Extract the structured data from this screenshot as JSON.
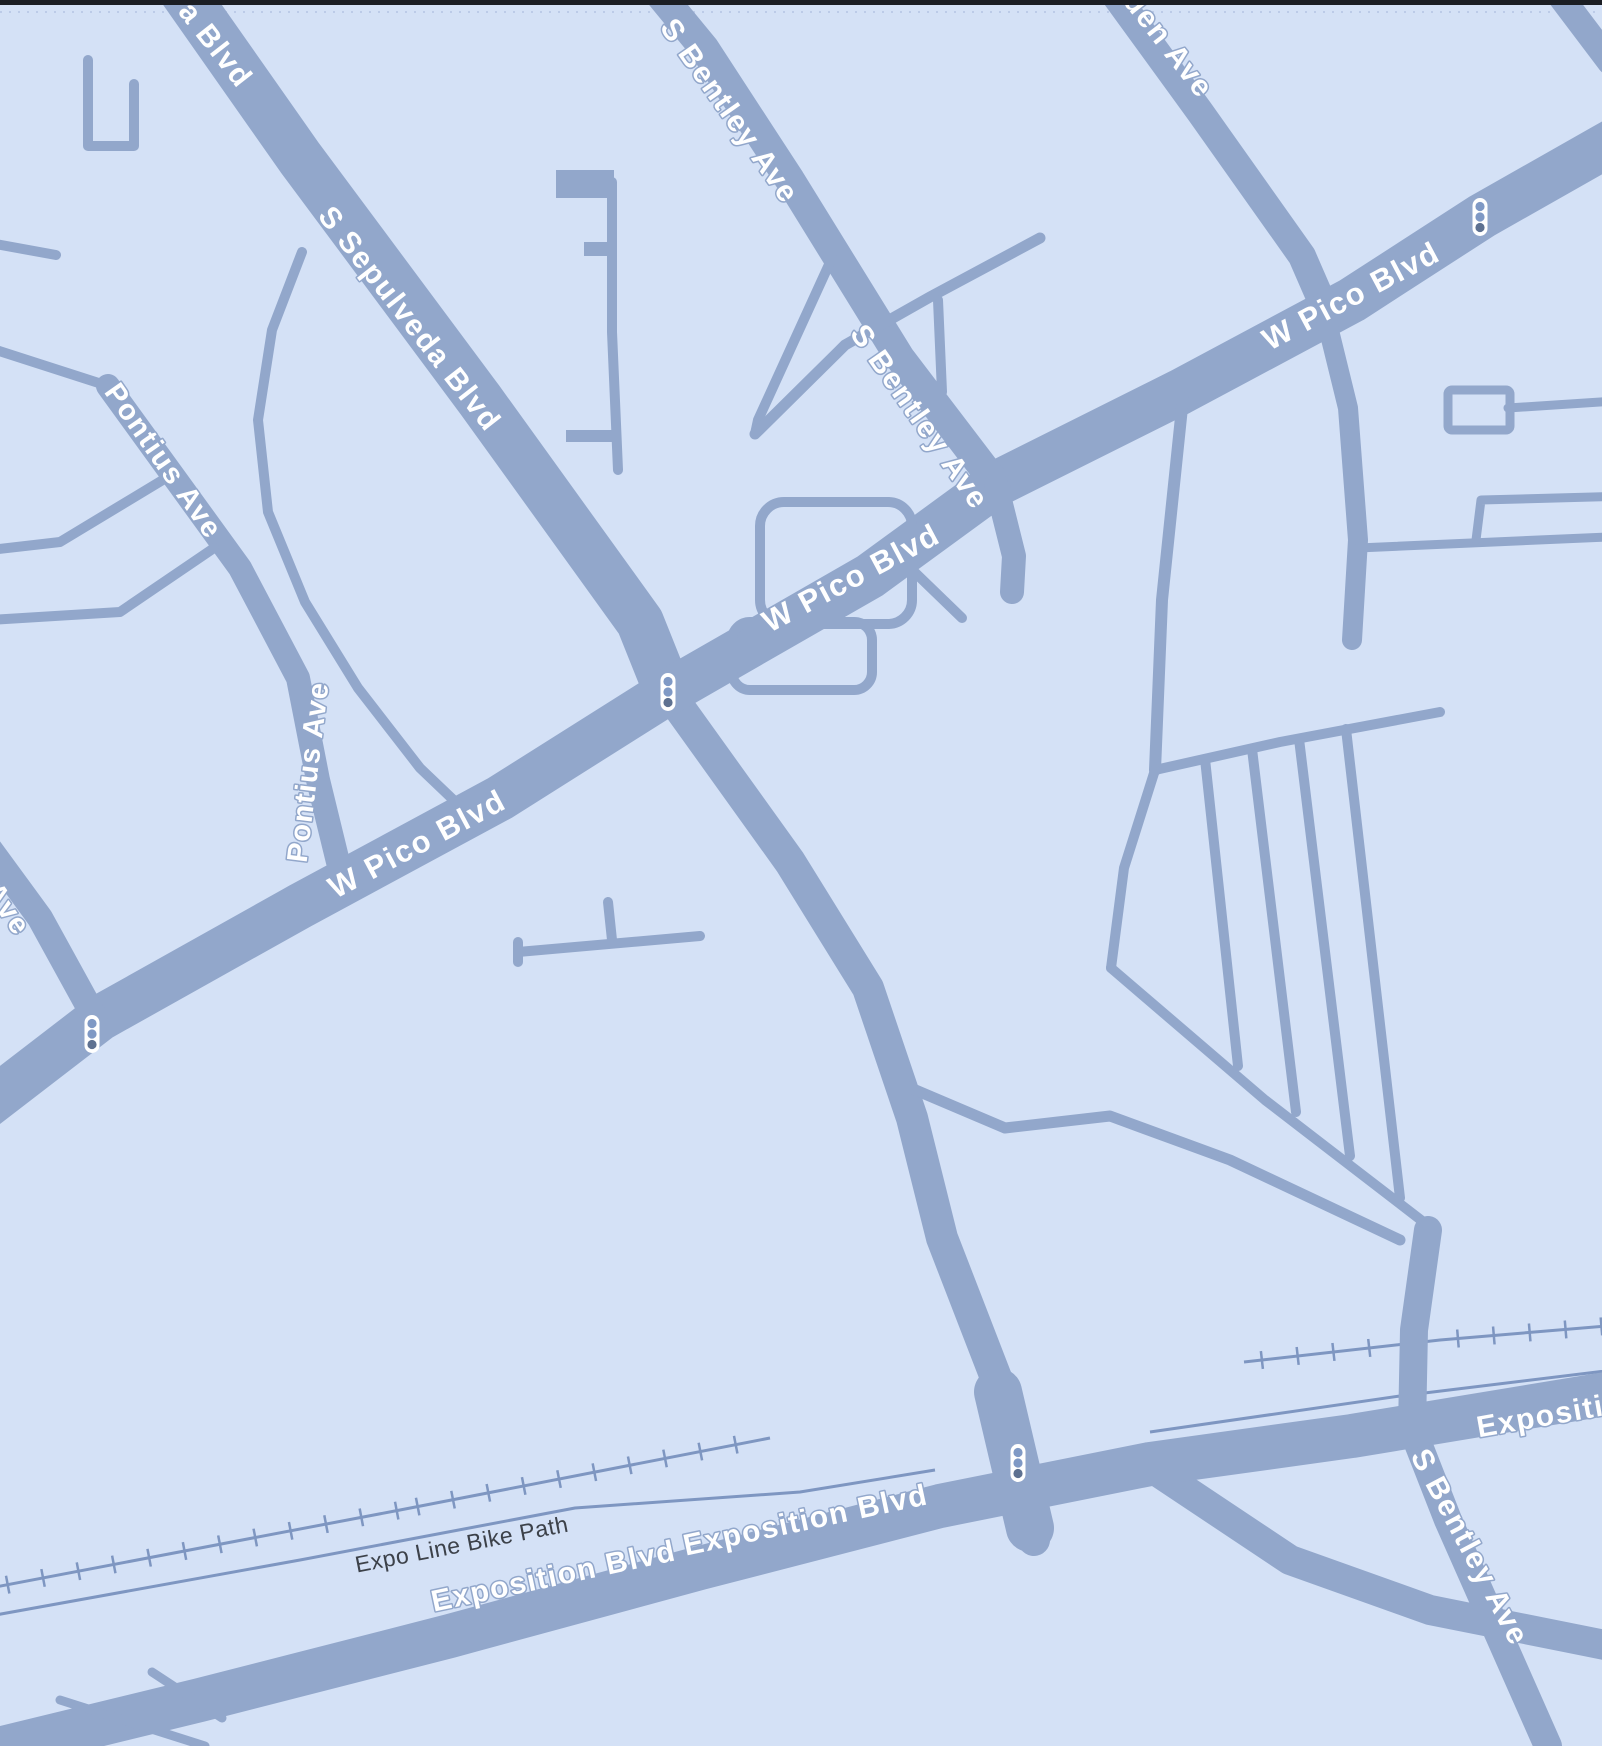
{
  "map": {
    "width": 1602,
    "height": 1746,
    "colors": {
      "background": "#d4e1f6",
      "road": "#92a7cb",
      "rail": "#7e96c1",
      "label_white": "#ffffff",
      "label_dark": "#3c4149",
      "top_bar": "#1b1e24",
      "boundary_dots": "#bccbe8",
      "signal_body": "#ffffff",
      "signal_lens": "#7f99c5",
      "signal_lens_dark": "#5e7191"
    },
    "top_bar_height": 5,
    "boundary_line_y": 12,
    "roads": [
      {
        "name": "road-s-sepulveda-blvd-north",
        "width": 48,
        "points": [
          [
            175,
            -20
          ],
          [
            300,
            158
          ],
          [
            480,
            400
          ],
          [
            640,
            622
          ],
          [
            668,
            692
          ]
        ]
      },
      {
        "name": "road-s-sepulveda-blvd-south",
        "width": 32,
        "points": [
          [
            668,
            692
          ],
          [
            790,
            862
          ],
          [
            868,
            988
          ],
          [
            912,
            1118
          ],
          [
            942,
            1238
          ],
          [
            1000,
            1388
          ],
          [
            1018,
            1462
          ],
          [
            1034,
            1540
          ]
        ]
      },
      {
        "name": "road-sepulveda-exposition-junction",
        "width": 48,
        "points": [
          [
            998,
            1392
          ],
          [
            1030,
            1528
          ]
        ]
      },
      {
        "name": "road-w-pico-blvd",
        "width": 46,
        "points": [
          [
            -30,
            1118
          ],
          [
            100,
            1018
          ],
          [
            300,
            906
          ],
          [
            500,
            798
          ],
          [
            668,
            692
          ],
          [
            870,
            576
          ],
          [
            996,
            484
          ],
          [
            1180,
            392
          ],
          [
            1352,
            300
          ],
          [
            1482,
            216
          ],
          [
            1630,
            132
          ]
        ]
      },
      {
        "name": "road-s-bentley-ave-north",
        "width": 30,
        "points": [
          [
            648,
            -20
          ],
          [
            704,
            48
          ],
          [
            790,
            180
          ],
          [
            900,
            358
          ],
          [
            996,
            484
          ]
        ]
      },
      {
        "name": "road-s-bentley-ave-stub",
        "width": 24,
        "points": [
          [
            996,
            484
          ],
          [
            1014,
            556
          ],
          [
            1012,
            592
          ]
        ]
      },
      {
        "name": "road-den-ave",
        "width": 28,
        "points": [
          [
            1104,
            -20
          ],
          [
            1200,
            112
          ],
          [
            1302,
            256
          ],
          [
            1322,
            302
          ]
        ]
      },
      {
        "name": "road-den-ave-south",
        "width": 20,
        "points": [
          [
            1322,
            302
          ],
          [
            1348,
            408
          ],
          [
            1358,
            540
          ],
          [
            1352,
            640
          ]
        ]
      },
      {
        "name": "road-ave-west",
        "width": 26,
        "points": [
          [
            -20,
            836
          ],
          [
            40,
            918
          ],
          [
            95,
            1018
          ]
        ]
      },
      {
        "name": "road-s-bentley-ave-south",
        "width": 28,
        "points": [
          [
            1428,
            1230
          ],
          [
            1414,
            1330
          ],
          [
            1412,
            1428
          ],
          [
            1448,
            1520
          ],
          [
            1502,
            1642
          ],
          [
            1548,
            1746
          ]
        ]
      },
      {
        "name": "road-south-band",
        "width": 30,
        "points": [
          [
            1152,
            1468
          ],
          [
            1290,
            1560
          ],
          [
            1430,
            1610
          ],
          [
            1630,
            1650
          ]
        ]
      },
      {
        "name": "road-exposition-blvd",
        "width": 44,
        "points": [
          [
            -30,
            1756
          ],
          [
            200,
            1700
          ],
          [
            450,
            1636
          ],
          [
            700,
            1568
          ],
          [
            940,
            1506
          ],
          [
            1150,
            1464
          ],
          [
            1352,
            1436
          ],
          [
            1630,
            1390
          ]
        ]
      },
      {
        "name": "road-corner-ne",
        "width": 26,
        "points": [
          [
            1548,
            -20
          ],
          [
            1610,
            62
          ]
        ]
      },
      {
        "name": "road-pontius-ave",
        "width": 24,
        "points": [
          [
            108,
            386
          ],
          [
            240,
            568
          ],
          [
            298,
            678
          ],
          [
            318,
            780
          ],
          [
            338,
            862
          ],
          [
            352,
            884
          ]
        ]
      },
      {
        "name": "road-hook-top-left",
        "width": 10,
        "points": [
          [
            88,
            60
          ],
          [
            88,
            146
          ],
          [
            134,
            146
          ],
          [
            134,
            84
          ]
        ]
      },
      {
        "name": "road-left-stub-1",
        "width": 10,
        "points": [
          [
            -10,
            243
          ],
          [
            56,
            255
          ]
        ]
      },
      {
        "name": "road-pontius-link",
        "width": 10,
        "points": [
          [
            -10,
            348
          ],
          [
            108,
            386
          ]
        ]
      },
      {
        "name": "road-pontius-side-1",
        "width": 10,
        "points": [
          [
            166,
            478
          ],
          [
            60,
            542
          ],
          [
            -10,
            550
          ]
        ]
      },
      {
        "name": "road-pontius-side-2",
        "width": 10,
        "points": [
          [
            214,
            548
          ],
          [
            120,
            612
          ],
          [
            -10,
            620
          ]
        ]
      },
      {
        "name": "road-sepulveda-loop",
        "width": 10,
        "points": [
          [
            302,
            252
          ],
          [
            272,
            330
          ],
          [
            258,
            420
          ],
          [
            268,
            512
          ],
          [
            305,
            602
          ],
          [
            358,
            688
          ],
          [
            420,
            768
          ],
          [
            464,
            810
          ]
        ]
      },
      {
        "name": "road-alley-vertical",
        "width": 10,
        "points": [
          [
            612,
            182
          ],
          [
            612,
            332
          ],
          [
            618,
            470
          ]
        ]
      },
      {
        "name": "road-alley-branch",
        "width": 10,
        "points": [
          [
            832,
            258
          ],
          [
            758,
            420
          ],
          [
            755,
            434
          ]
        ]
      },
      {
        "name": "road-cross-street",
        "width": 11,
        "points": [
          [
            755,
            434
          ],
          [
            838,
            352
          ],
          [
            845,
            345
          ],
          [
            930,
            297
          ],
          [
            1040,
            238
          ]
        ]
      },
      {
        "name": "road-cross-stub",
        "width": 10,
        "points": [
          [
            938,
            300
          ],
          [
            942,
            392
          ]
        ]
      },
      {
        "name": "road-short-diagonal",
        "width": 10,
        "points": [
          [
            902,
            560
          ],
          [
            962,
            618
          ]
        ]
      },
      {
        "name": "road-t-stub",
        "width": 10,
        "points": [
          [
            518,
            952
          ],
          [
            700,
            936
          ]
        ]
      },
      {
        "name": "road-t-stub-up",
        "width": 10,
        "points": [
          [
            612,
            940
          ],
          [
            608,
            902
          ]
        ]
      },
      {
        "name": "road-t-stub-tick",
        "width": 10,
        "points": [
          [
            518,
            962
          ],
          [
            518,
            942
          ]
        ]
      },
      {
        "name": "road-military-link",
        "width": 12,
        "points": [
          [
            1183,
            398
          ],
          [
            1162,
            600
          ],
          [
            1155,
            770
          ]
        ]
      },
      {
        "name": "road-fan-top",
        "width": 10,
        "points": [
          [
            1155,
            770
          ],
          [
            1280,
            742
          ],
          [
            1440,
            712
          ]
        ]
      },
      {
        "name": "road-fan-left",
        "width": 10,
        "points": [
          [
            1155,
            770
          ],
          [
            1124,
            868
          ],
          [
            1111,
            968
          ]
        ]
      },
      {
        "name": "road-fan-bottom",
        "width": 10,
        "points": [
          [
            1111,
            968
          ],
          [
            1265,
            1100
          ],
          [
            1430,
            1227
          ]
        ]
      },
      {
        "name": "road-fan-1",
        "width": 10,
        "points": [
          [
            1205,
            759
          ],
          [
            1238,
            1066
          ]
        ]
      },
      {
        "name": "road-fan-2",
        "width": 10,
        "points": [
          [
            1252,
            749
          ],
          [
            1296,
            1112
          ]
        ]
      },
      {
        "name": "road-fan-3",
        "width": 10,
        "points": [
          [
            1299,
            739
          ],
          [
            1350,
            1156
          ]
        ]
      },
      {
        "name": "road-fan-4",
        "width": 10,
        "points": [
          [
            1346,
            729
          ],
          [
            1400,
            1198
          ]
        ]
      },
      {
        "name": "road-below-fan",
        "width": 11,
        "points": [
          [
            906,
            1086
          ],
          [
            1005,
            1128
          ],
          [
            1110,
            1116
          ],
          [
            1230,
            1160
          ],
          [
            1400,
            1240
          ]
        ]
      },
      {
        "name": "road-bottom-left-1",
        "width": 9,
        "points": [
          [
            60,
            1700
          ],
          [
            205,
            1746
          ]
        ]
      },
      {
        "name": "road-bottom-left-2",
        "width": 9,
        "points": [
          [
            152,
            1672
          ],
          [
            222,
            1718
          ]
        ]
      },
      {
        "name": "road-right-stub",
        "width": 9,
        "points": [
          [
            1508,
            408
          ],
          [
            1630,
            400
          ]
        ]
      },
      {
        "name": "road-right-a",
        "width": 9,
        "points": [
          [
            1358,
            548
          ],
          [
            1630,
            536
          ]
        ]
      },
      {
        "name": "road-right-b",
        "width": 9,
        "points": [
          [
            1476,
            540
          ],
          [
            1481,
            500
          ],
          [
            1630,
            496
          ]
        ]
      }
    ],
    "road_rects": [
      {
        "name": "block-notch-1",
        "x": 556,
        "y": 170,
        "w": 58,
        "h": 28
      },
      {
        "name": "block-notch-2",
        "x": 584,
        "y": 242,
        "w": 28,
        "h": 14
      },
      {
        "name": "block-notch-3",
        "x": 566,
        "y": 430,
        "w": 52,
        "h": 12
      }
    ],
    "road_outline_rects": [
      {
        "name": "loop-block-upper",
        "x": 760,
        "y": 502,
        "w": 152,
        "h": 122,
        "r": 24,
        "width": 10
      },
      {
        "name": "loop-block-lower",
        "x": 732,
        "y": 622,
        "w": 140,
        "h": 68,
        "r": 18,
        "width": 10
      },
      {
        "name": "right-edge-block",
        "x": 1448,
        "y": 390,
        "w": 62,
        "h": 40,
        "r": 4,
        "width": 9
      }
    ],
    "rails": [
      {
        "name": "expo-line-west",
        "ticks": true,
        "points": [
          [
            -10,
            1588
          ],
          [
            400,
            1510
          ],
          [
            770,
            1438
          ]
        ]
      },
      {
        "name": "expo-line-east",
        "ticks": true,
        "points": [
          [
            1244,
            1362
          ],
          [
            1440,
            1340
          ],
          [
            1630,
            1324
          ]
        ]
      },
      {
        "name": "bike-path-west",
        "ticks": false,
        "points": [
          [
            -10,
            1616
          ],
          [
            300,
            1560
          ],
          [
            575,
            1508
          ],
          [
            800,
            1492
          ],
          [
            935,
            1470
          ]
        ]
      },
      {
        "name": "bike-path-east",
        "ticks": false,
        "points": [
          [
            1150,
            1432
          ],
          [
            1400,
            1396
          ],
          [
            1630,
            1368
          ]
        ]
      }
    ],
    "labels": [
      {
        "text": "a Blvd",
        "x": 214,
        "y": 46,
        "rotation": 52,
        "size": 30,
        "kind": "road"
      },
      {
        "text": "S Sepulveda Blvd",
        "x": 408,
        "y": 320,
        "rotation": 52,
        "size": 30,
        "kind": "road"
      },
      {
        "text": "S Bentley Ave",
        "x": 728,
        "y": 112,
        "rotation": 55,
        "size": 30,
        "kind": "road"
      },
      {
        "text": "S Bentley Ave",
        "x": 918,
        "y": 418,
        "rotation": 55,
        "size": 30,
        "kind": "road"
      },
      {
        "text": "den Ave",
        "x": 1167,
        "y": 46,
        "rotation": 52,
        "size": 30,
        "kind": "road"
      },
      {
        "text": "W Pico Blvd",
        "x": 1352,
        "y": 298,
        "rotation": -28,
        "size": 31,
        "kind": "road"
      },
      {
        "text": "W Pico Blvd",
        "x": 852,
        "y": 580,
        "rotation": -28,
        "size": 31,
        "kind": "road"
      },
      {
        "text": "W Pico Blvd",
        "x": 418,
        "y": 846,
        "rotation": -28,
        "size": 31,
        "kind": "road"
      },
      {
        "text": "Pontius Ave",
        "x": 162,
        "y": 462,
        "rotation": 55,
        "size": 29,
        "kind": "road"
      },
      {
        "text": "Pontius Ave",
        "x": 310,
        "y": 772,
        "rotation": -83,
        "size": 29,
        "kind": "road"
      },
      {
        "text": "Ave",
        "x": 6,
        "y": 910,
        "rotation": 55,
        "size": 29,
        "kind": "road"
      },
      {
        "text": "Expo Line Bike Path",
        "x": 462,
        "y": 1546,
        "rotation": -11,
        "size": 23,
        "kind": "path"
      },
      {
        "text": "Exposition Blvd",
        "x": 554,
        "y": 1578,
        "rotation": -12,
        "size": 30,
        "kind": "road"
      },
      {
        "text": "Exposition Blvd",
        "x": 806,
        "y": 1522,
        "rotation": -12,
        "size": 30,
        "kind": "road"
      },
      {
        "text": "Exposition Blvd",
        "x": 1600,
        "y": 1408,
        "rotation": -10,
        "size": 30,
        "kind": "road"
      },
      {
        "text": "S Bentley Ave",
        "x": 1468,
        "y": 1548,
        "rotation": 62,
        "size": 30,
        "kind": "road"
      }
    ],
    "traffic_lights": [
      {
        "x": 668,
        "y": 692
      },
      {
        "x": 92,
        "y": 1034
      },
      {
        "x": 1018,
        "y": 1463
      },
      {
        "x": 1480,
        "y": 217
      }
    ]
  }
}
